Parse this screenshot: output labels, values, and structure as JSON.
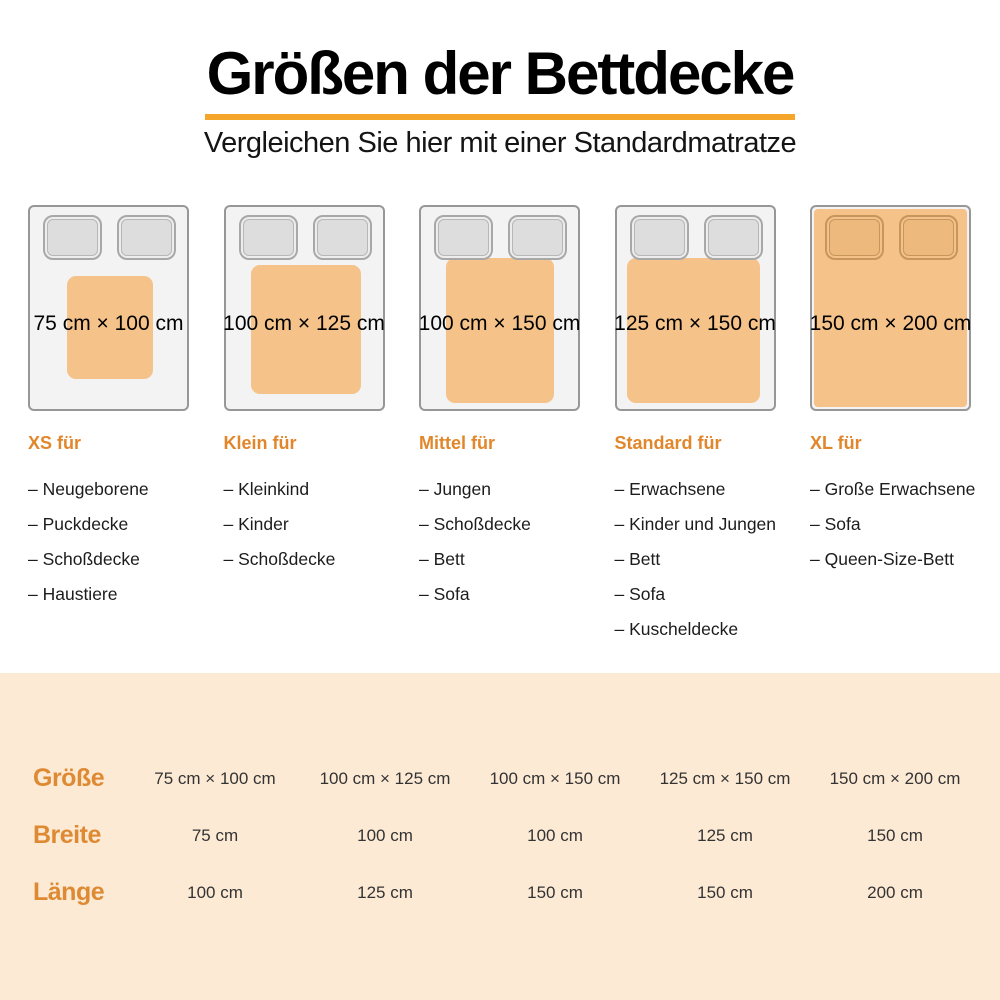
{
  "header": {
    "title": "Größen der Bettdecke",
    "subtitle": "Vergleichen Sie hier mit einer Standardmatratze"
  },
  "colors": {
    "title_underline": "#F5A62A",
    "heading_orange": "#E2862B",
    "table_label_orange": "#DE8A33",
    "duvet_orange": "#F5C38A",
    "band_background": "#FCEAD5"
  },
  "list_marker": "–",
  "cards": [
    {
      "size_label": "75 cm × 100 cm",
      "heading": "XS für",
      "items": [
        "Neugeborene",
        "Puckdecke",
        "Schoßdecke",
        "Haustiere"
      ],
      "covers_pillows": false,
      "duvet": {
        "left": "23.5%",
        "top": "34%",
        "width": "55%",
        "height": "51%"
      }
    },
    {
      "size_label": "100 cm × 125 cm",
      "heading": "Klein für",
      "items": [
        "Kleinkind",
        "Kinder",
        "Schoßdecke"
      ],
      "covers_pillows": false,
      "duvet": {
        "left": "16%",
        "top": "28.5%",
        "width": "70%",
        "height": "64%"
      }
    },
    {
      "size_label": "100 cm × 150 cm",
      "heading": "Mittel für",
      "items": [
        "Jungen",
        "Schoßdecke",
        "Bett",
        "Sofa"
      ],
      "covers_pillows": false,
      "duvet": {
        "left": "16%",
        "top": "25%",
        "width": "69%",
        "height": "72%"
      }
    },
    {
      "size_label": "125 cm × 150 cm",
      "heading": "Standard für",
      "items": [
        "Erwachsene",
        "Kinder und Jungen",
        "Bett",
        "Sofa",
        "Kuscheldecke"
      ],
      "covers_pillows": false,
      "duvet": {
        "left": "6.5%",
        "top": "25%",
        "width": "85%",
        "height": "72%"
      }
    },
    {
      "size_label": "150 cm × 200 cm",
      "heading": "XL für",
      "items": [
        "Große Erwachsene",
        "Sofa",
        "Queen-Size-Bett"
      ],
      "covers_pillows": true,
      "duvet": {
        "left": "1%",
        "top": "1%",
        "width": "98%",
        "height": "98%"
      }
    }
  ],
  "table": {
    "rows": [
      {
        "label": "Größe",
        "values": [
          "75 cm × 100 cm",
          "100 cm × 125 cm",
          "100 cm × 150 cm",
          "125 cm × 150 cm",
          "150 cm × 200 cm"
        ]
      },
      {
        "label": "Breite",
        "values": [
          "75 cm",
          "100 cm",
          "100 cm",
          "125 cm",
          "150 cm"
        ]
      },
      {
        "label": "Länge",
        "values": [
          "100 cm",
          "125 cm",
          "150 cm",
          "150 cm",
          "200 cm"
        ]
      }
    ]
  }
}
